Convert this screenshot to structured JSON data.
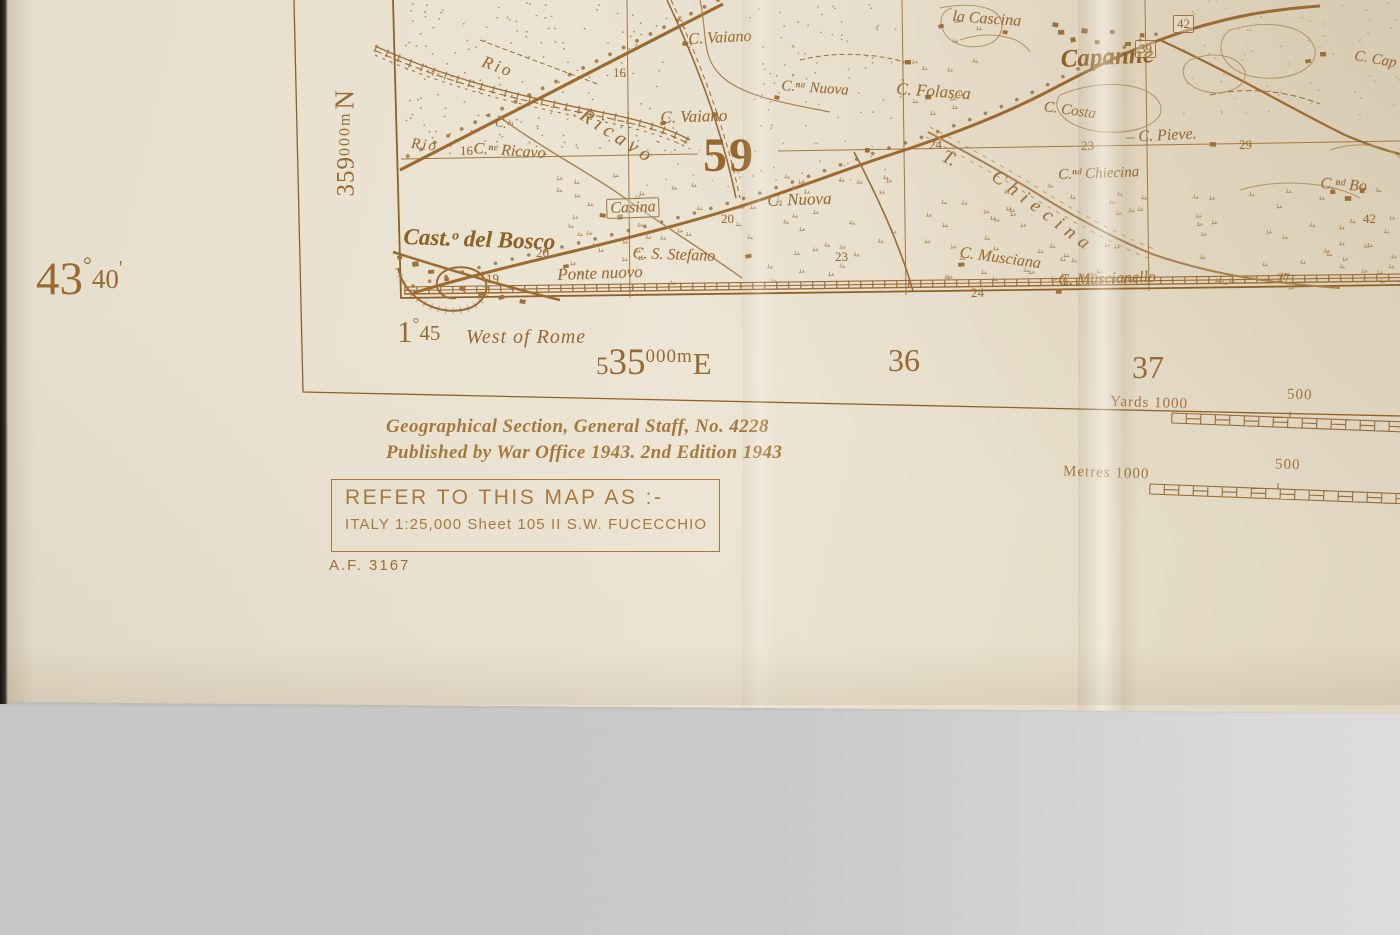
{
  "colors": {
    "ink": "#9b6c34",
    "ink_dark": "#8f6125",
    "paper": "#e9e2d1",
    "fabric": "#c9c8c6"
  },
  "margin": {
    "northing": {
      "n1": "359",
      "n2": "000m",
      "n3": "N"
    },
    "latitude": {
      "deg": "43",
      "degsym": "°",
      "min": "40",
      "prime": "'"
    },
    "longitude": {
      "deg": "1",
      "degsym": "°",
      "min": "45"
    },
    "west_of_rome": "West of Rome",
    "easting": {
      "p1": "5",
      "p2": "35",
      "p3": "000m",
      "p4": "E"
    },
    "easting_36": "36",
    "easting_37": "37"
  },
  "map_face": {
    "grid_number_large": "59",
    "place_labels": [
      {
        "t": "Rio",
        "x": 486,
        "y": 52,
        "r": 20,
        "s": 17,
        "ls": 3
      },
      {
        "t": "Rio",
        "x": 412,
        "y": 136,
        "r": 6,
        "s": 15,
        "ls": 2
      },
      {
        "t": "C.ˡᵒ",
        "x": 497,
        "y": 114,
        "r": 12,
        "s": 13
      },
      {
        "t": "C.ⁿᵉ Ricavo",
        "x": 474,
        "y": 140,
        "r": 4,
        "s": 16
      },
      {
        "t": "Ricavo",
        "x": 588,
        "y": 104,
        "r": 33,
        "s": 20,
        "ls": 5
      },
      {
        "t": "C. Vaiano",
        "x": 688,
        "y": 31,
        "r": -3,
        "s": 16
      },
      {
        "t": "C. Vaiano",
        "x": 660,
        "y": 108,
        "r": -2,
        "s": 17
      },
      {
        "t": "C.ⁿᵃ Nuova",
        "x": 782,
        "y": 78,
        "r": 4,
        "s": 15
      },
      {
        "t": "C. Folasca",
        "x": 897,
        "y": 79,
        "r": 4,
        "s": 17
      },
      {
        "t": "la Cascina",
        "x": 953,
        "y": 8,
        "r": 4,
        "s": 16
      },
      {
        "t": "Capanne",
        "x": 1060,
        "y": 46,
        "r": -3,
        "s": 25,
        "b": 1
      },
      {
        "t": "C. Costa",
        "x": 1045,
        "y": 99,
        "r": 8,
        "s": 15
      },
      {
        "t": "– C. Pieve.",
        "x": 1126,
        "y": 129,
        "r": -3,
        "s": 16
      },
      {
        "t": "C.ⁿᵈ Chiecina",
        "x": 1058,
        "y": 167,
        "r": -2,
        "s": 15
      },
      {
        "t": "T.",
        "x": 948,
        "y": 146,
        "r": 28,
        "s": 19
      },
      {
        "t": "Chiecina",
        "x": 1000,
        "y": 166,
        "r": 37,
        "s": 19,
        "ls": 7
      },
      {
        "t": "Casina",
        "x": 606,
        "y": 199,
        "r": -2,
        "s": 16,
        "box": 1
      },
      {
        "t": "C. Nuova",
        "x": 767,
        "y": 191,
        "r": -2,
        "s": 17
      },
      {
        "t": "Cast.ᵒ del Bosco",
        "x": 404,
        "y": 224,
        "r": 2,
        "s": 23,
        "b": 1
      },
      {
        "t": "C. S. Stefano",
        "x": 633,
        "y": 245,
        "r": 2,
        "s": 16
      },
      {
        "t": "Ponte nuovo",
        "x": 557,
        "y": 265,
        "r": -2,
        "s": 17
      },
      {
        "t": "C. Musciana",
        "x": 961,
        "y": 244,
        "r": 8,
        "s": 16
      },
      {
        "t": "C. Muscianello",
        "x": 1058,
        "y": 272,
        "r": -2,
        "s": 16
      },
      {
        "t": "C. Cap",
        "x": 1356,
        "y": 48,
        "r": 10,
        "s": 15
      },
      {
        "t": "C.ⁿᵈ Bo",
        "x": 1321,
        "y": 175,
        "r": 4,
        "s": 16
      }
    ],
    "spot_numbers": [
      {
        "t": "16",
        "x": 460,
        "y": 143
      },
      {
        "t": "16",
        "x": 613,
        "y": 65
      },
      {
        "t": "20",
        "x": 536,
        "y": 245
      },
      {
        "t": "20",
        "x": 721,
        "y": 211
      },
      {
        "t": "19",
        "x": 486,
        "y": 271
      },
      {
        "t": "23",
        "x": 835,
        "y": 249
      },
      {
        "t": "23",
        "x": 1081,
        "y": 138
      },
      {
        "t": "24",
        "x": 929,
        "y": 137
      },
      {
        "t": "24",
        "x": 971,
        "y": 285
      },
      {
        "t": "27",
        "x": 1277,
        "y": 270
      },
      {
        "t": "29",
        "x": 1239,
        "y": 137
      },
      {
        "t": "39",
        "x": 1135,
        "y": 40,
        "box": 1
      },
      {
        "t": "42",
        "x": 1173,
        "y": 15,
        "box": 1
      },
      {
        "t": "42",
        "x": 1363,
        "y": 211
      }
    ]
  },
  "imprint": {
    "line1": "Geographical Section, General Staff, No. 4228",
    "line2": "Published by War Office 1943.  2nd Edition 1943"
  },
  "refer_box": {
    "line1": "REFER TO THIS MAP AS :-",
    "line2": "ITALY 1:25,000 Sheet 105 II S.W. FUCECCHIO"
  },
  "stock_number": "A.F. 3167",
  "scale_bars": {
    "yards": {
      "label": "Yards 1000",
      "mid": "500"
    },
    "metres": {
      "label": "Metres 1000",
      "mid": "500"
    }
  }
}
